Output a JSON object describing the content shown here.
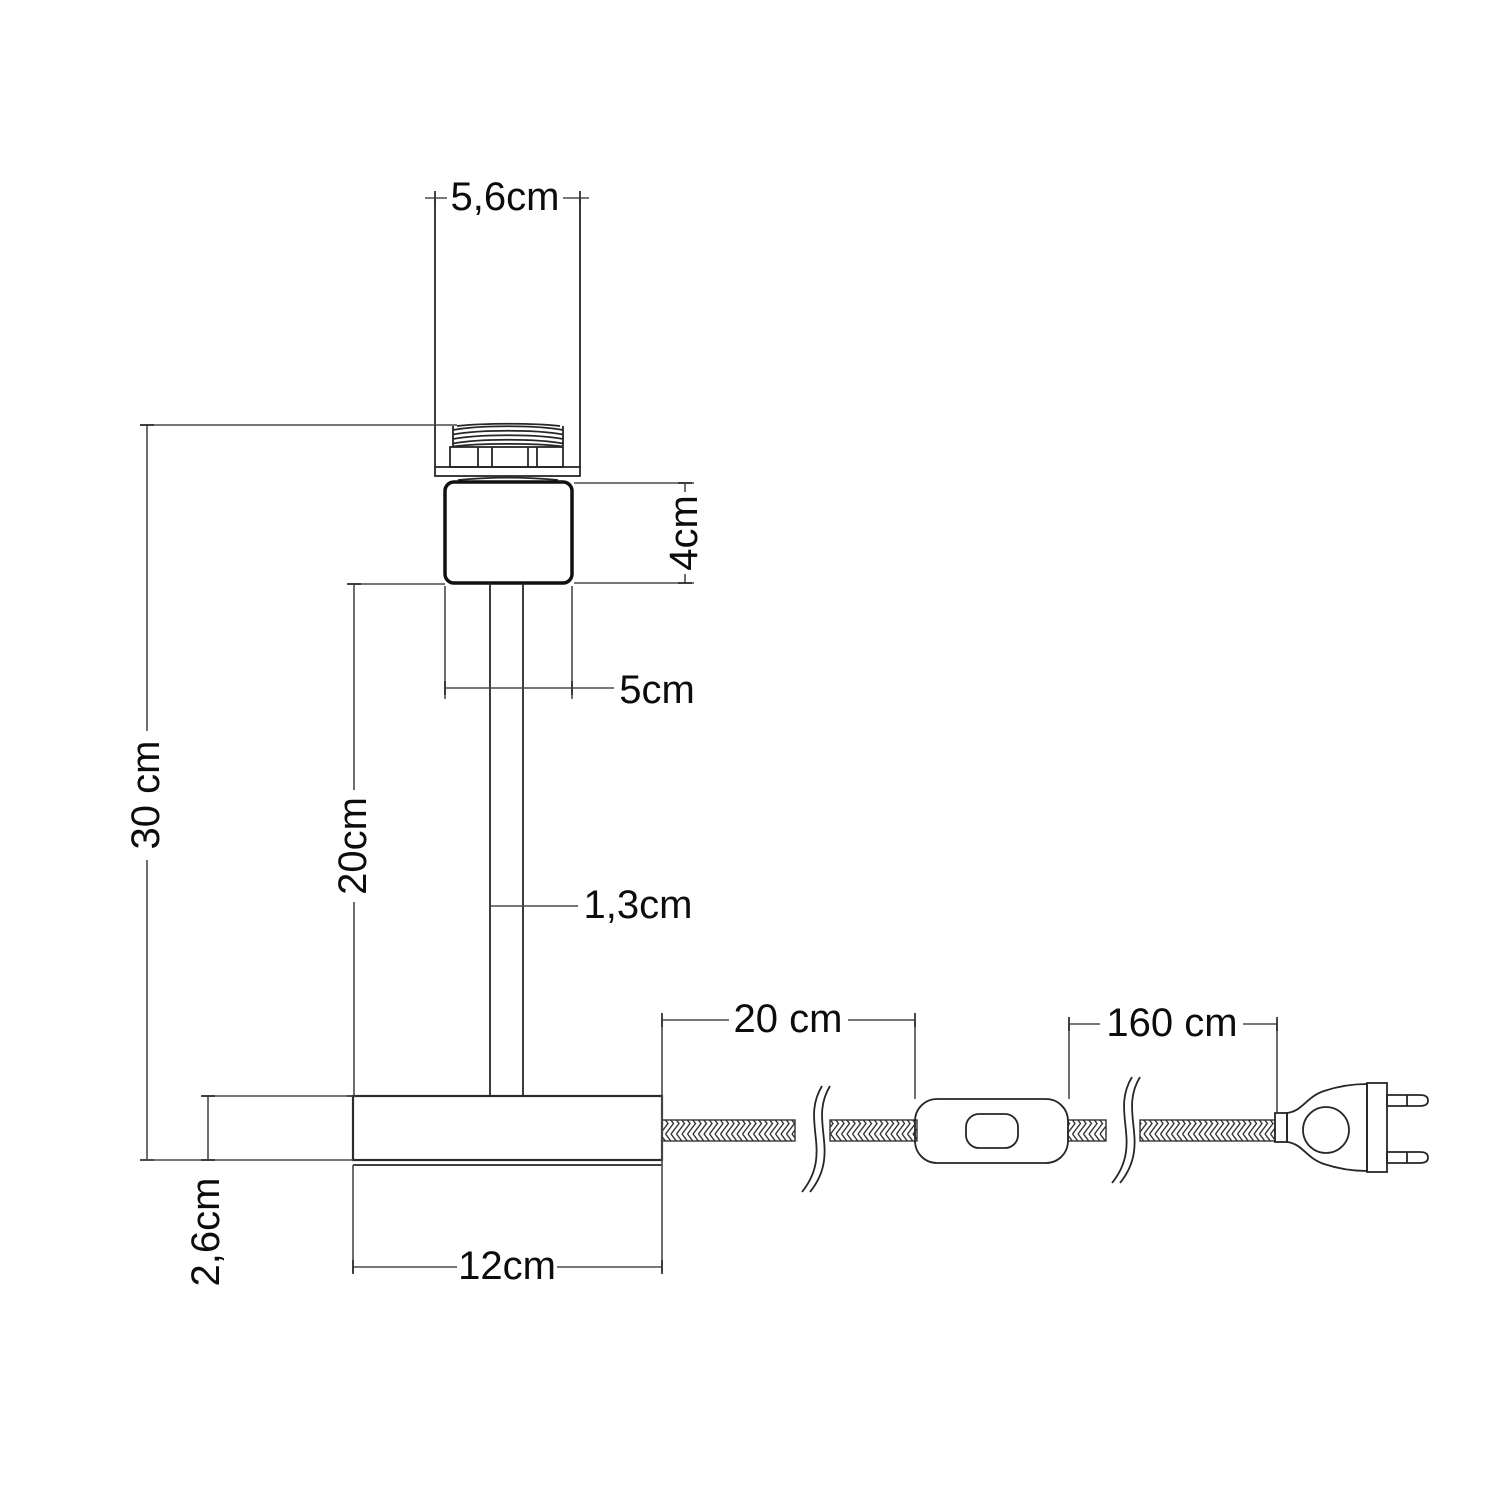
{
  "diagram": {
    "type": "technical-dimension-drawing",
    "subject": "table lamp base with inline switch and two-pin plug",
    "background_color": "#ffffff",
    "line_color": "#2b2b2b",
    "text_color": "#0c0c0c",
    "units": "cm",
    "dimensions": {
      "shade_width": "5,6cm",
      "holder_height": "4cm",
      "holder_width": "5cm",
      "overall_height": "30 cm",
      "stem_height": "20cm",
      "stem_diameter": "1,3cm",
      "base_height": "2,6cm",
      "base_width": "12cm",
      "cable_base_to_switch": "20 cm",
      "cable_switch_to_plug": "160 cm"
    }
  }
}
